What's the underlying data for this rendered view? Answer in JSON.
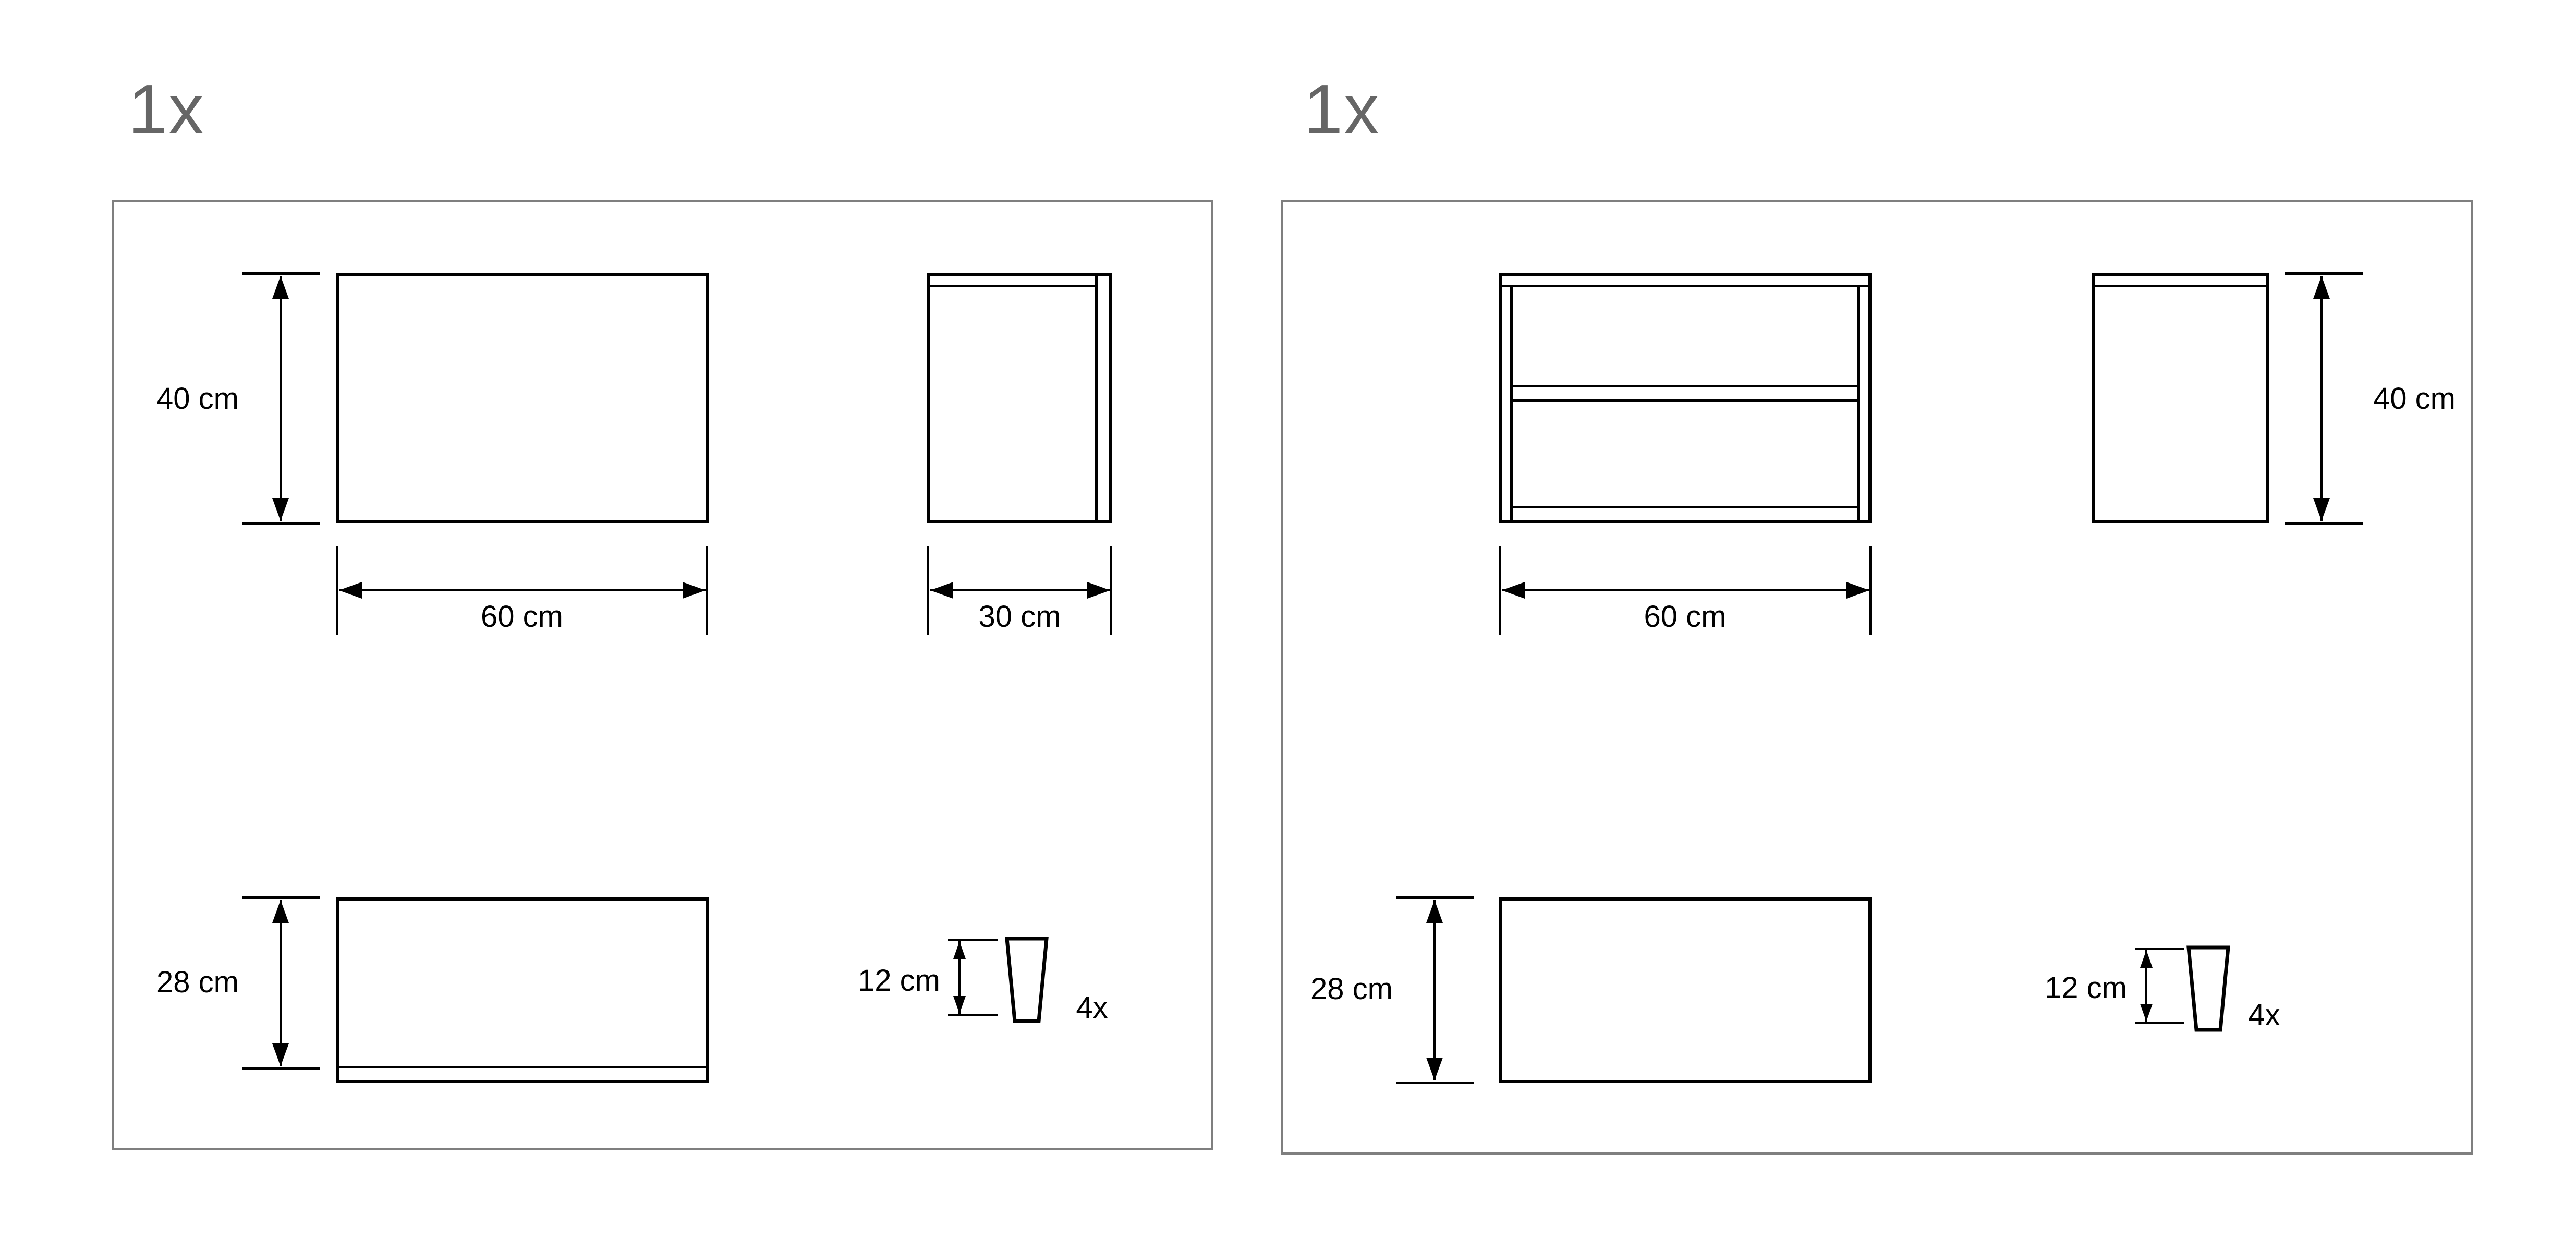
{
  "colors": {
    "background": "#ffffff",
    "panel_border": "#7f7f7f",
    "drawing_line": "#000000",
    "quantity_text": "#666666",
    "dimension_text": "#000000"
  },
  "panels": [
    {
      "quantity_label": "1x",
      "front_view": {
        "height_label": "40 cm",
        "width_label": "60 cm"
      },
      "side_view": {
        "width_label": "30 cm"
      },
      "plate_view": {
        "height_label": "28 cm"
      },
      "leg": {
        "height_label": "12 cm",
        "count_label": "4x"
      }
    },
    {
      "quantity_label": "1x",
      "front_view": {
        "width_label": "60 cm"
      },
      "side_view": {
        "height_label": "40 cm"
      },
      "plate_view": {
        "height_label": "28 cm"
      },
      "leg": {
        "height_label": "12 cm",
        "count_label": "4x"
      }
    }
  ]
}
